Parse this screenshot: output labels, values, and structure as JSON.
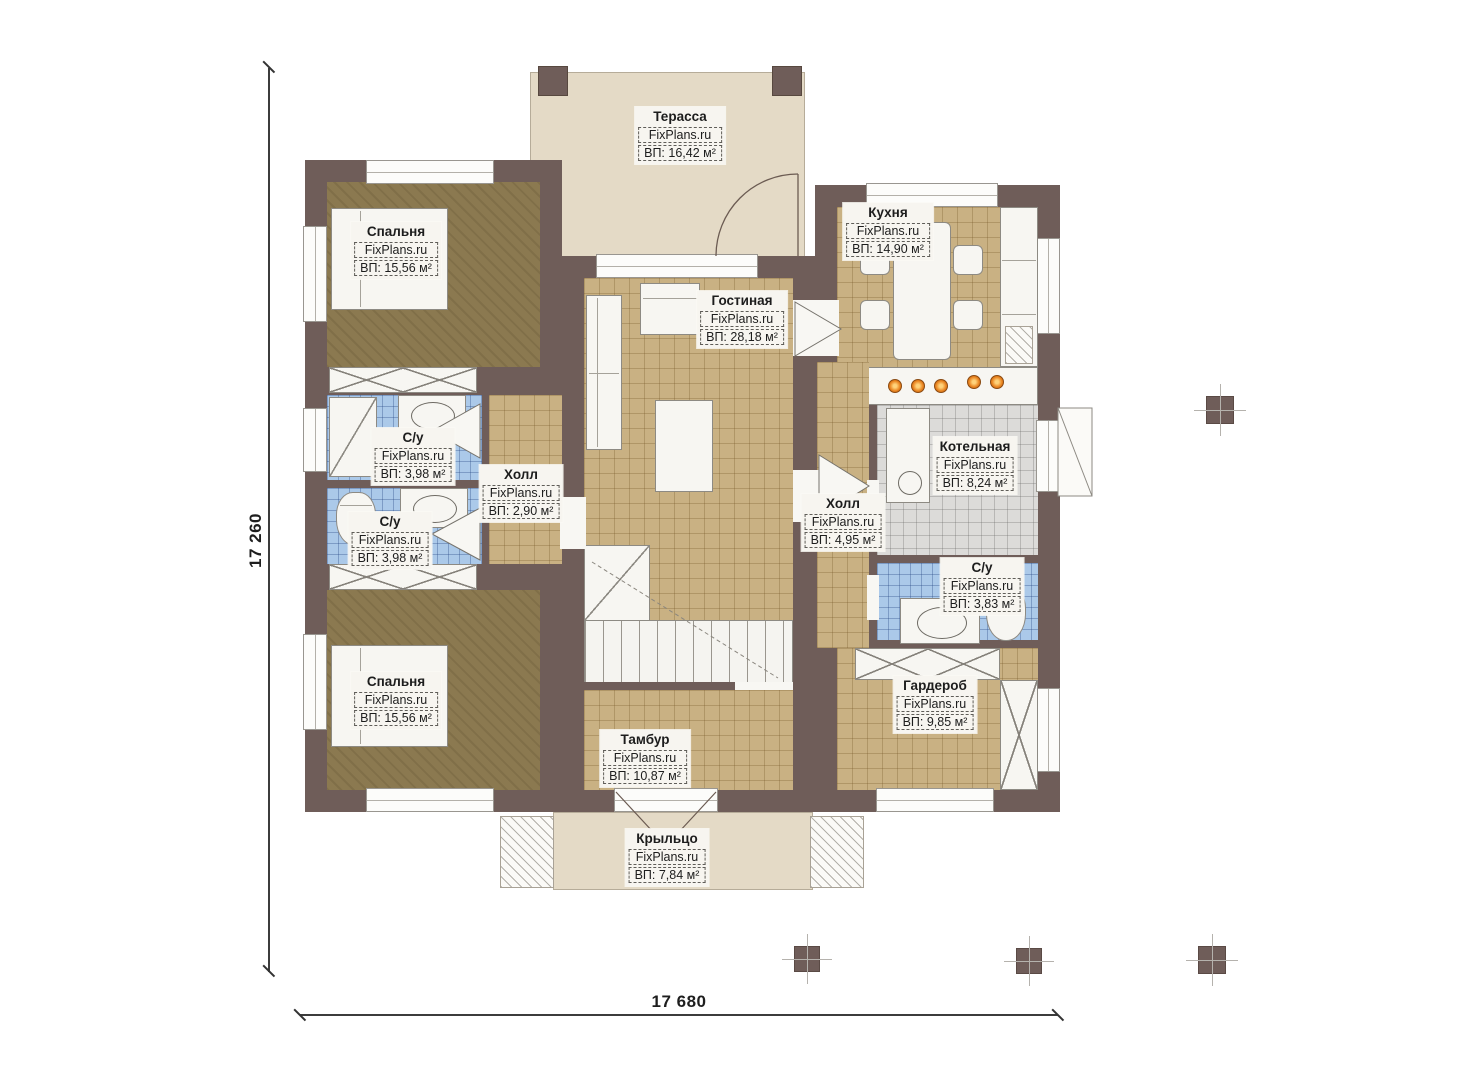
{
  "brand": "FixPlans.ru",
  "dimensions": {
    "vertical": "17 260",
    "horizontal": "17 680"
  },
  "rooms": {
    "terrace": {
      "name": "Терасса",
      "area": "ВП: 16,42 м²"
    },
    "bedroom_top": {
      "name": "Спальня",
      "area": "ВП: 15,56 м²"
    },
    "kitchen": {
      "name": "Кухня",
      "area": "ВП: 14,90 м²"
    },
    "living_room": {
      "name": "Гостиная",
      "area": "ВП: 28,18 м²"
    },
    "bathroom_top_left": {
      "name": "С/у",
      "area": "ВП: 3,98 м²"
    },
    "hall_left": {
      "name": "Холл",
      "area": "ВП: 2,90 м²"
    },
    "bathroom_bottom_left": {
      "name": "С/у",
      "area": "ВП: 3,98 м²"
    },
    "hall_right": {
      "name": "Холл",
      "area": "ВП: 4,95 м²"
    },
    "boiler_room": {
      "name": "Котельная",
      "area": "ВП: 8,24 м²"
    },
    "bathroom_right": {
      "name": "С/у",
      "area": "ВП: 3,83 м²"
    },
    "bedroom_bottom": {
      "name": "Спальня",
      "area": "ВП: 15,56 м²"
    },
    "wardrobe": {
      "name": "Гардероб",
      "area": "ВП: 9,85 м²"
    },
    "vestibule": {
      "name": "Тамбур",
      "area": "ВП: 10,87 м²"
    },
    "porch": {
      "name": "Крыльцо",
      "area": "ВП: 7,84 м²"
    }
  },
  "colors": {
    "wall": "#6f5d59",
    "floor_tan": "#c9b183",
    "floor_khaki": "#8b7950",
    "floor_blue": "#abc9e9",
    "floor_gray": "#dcdbd9",
    "terrace_beige": "#e4dac6",
    "burner_orange": "#e8821e"
  }
}
